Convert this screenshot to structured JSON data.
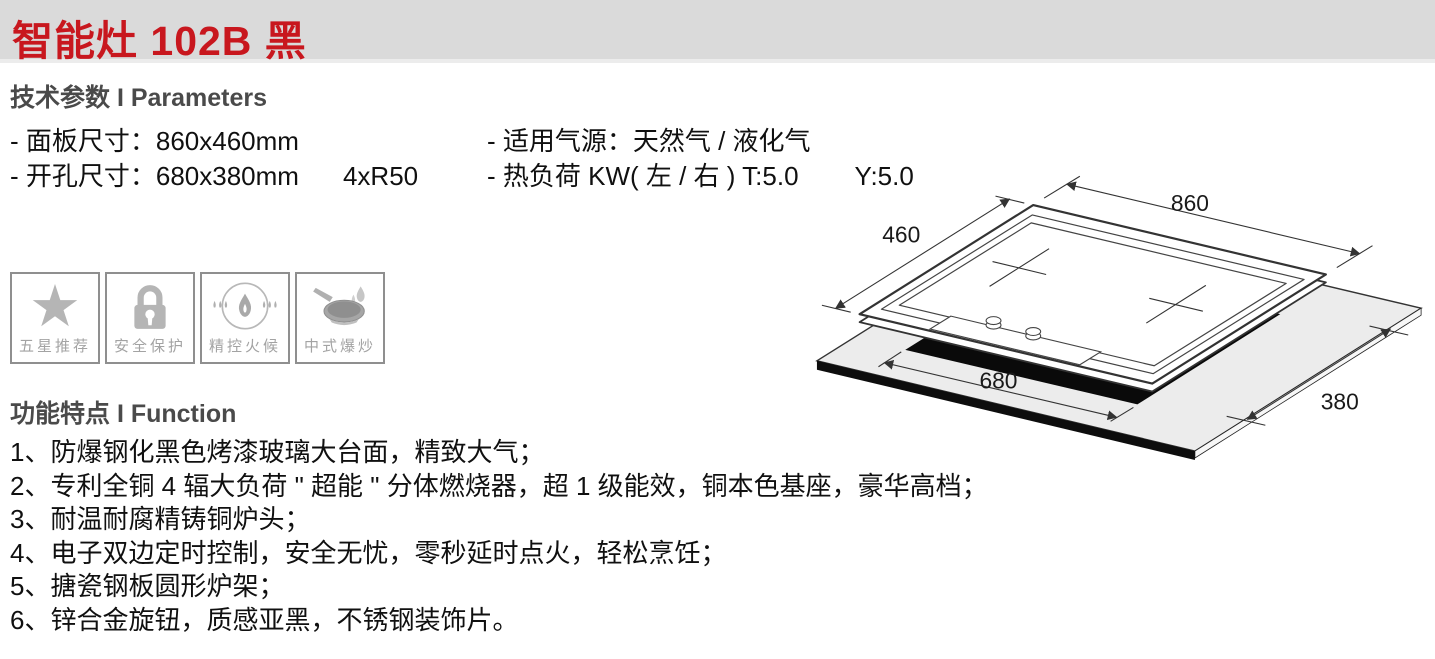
{
  "header": {
    "title": "智能灶 102B 黑",
    "band_color": "#dadada",
    "accent_color": "#c8171e"
  },
  "parameters": {
    "heading": "技术参数 I Parameters",
    "panel_size": "- 面板尺寸：860x460mm",
    "cutout_size": "- 开孔尺寸：680x380mm",
    "cutout_extra": "4xR50",
    "gas_source": "- 适用气源：天然气 / 液化气",
    "heat_load": "- 热负荷 KW( 左 / 右 )  T:5.0",
    "heat_load_y": "Y:5.0"
  },
  "badges": {
    "icon_color": "#b5b5b5",
    "border_color": "#8f8f8f",
    "star_glyph": "★",
    "items": [
      {
        "label": "五星推荐",
        "icon": "five-star-icon"
      },
      {
        "label": "安全保护",
        "icon": "safety-lock-icon"
      },
      {
        "label": "精控火候",
        "icon": "flame-control-icon"
      },
      {
        "label": "中式爆炒",
        "icon": "wok-stirfry-icon"
      }
    ]
  },
  "functions": {
    "heading": "功能特点 I Function",
    "items": [
      "1、防爆钢化黑色烤漆玻璃大台面，精致大气；",
      "2、专利全铜 4 辐大负荷 \" 超能 \" 分体燃烧器，超 1 级能效，铜本色基座，豪华高档；",
      "3、耐温耐腐精铸铜炉头；",
      "4、电子双边定时控制，安全无忧，零秒延时点火，轻松烹饪；",
      "5、搪瓷钢板圆形炉架；",
      "6、锌合金旋钮，质感亚黑，不锈钢装饰片。"
    ]
  },
  "diagram": {
    "panel_width_mm": "860",
    "panel_depth_mm": "460",
    "cutout_width_mm": "680",
    "cutout_depth_mm": "380"
  }
}
